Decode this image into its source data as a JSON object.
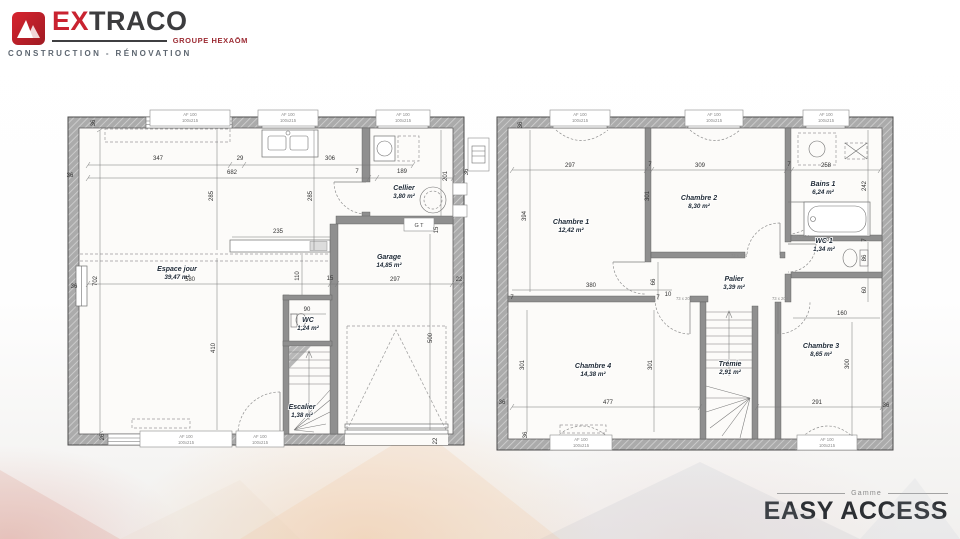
{
  "logo": {
    "brand_primary": "EX",
    "brand_secondary": "TRACO",
    "group_label": "GROUPE HEXAŌM",
    "tagline": "CONSTRUCTION - RÉNOVATION",
    "brand_red": "#c92330",
    "brand_dark": "#3c3c3e"
  },
  "footer": {
    "range_label": "Gamme",
    "range_name": "EASY ACCESS"
  },
  "plans": {
    "ground_floor": {
      "rooms": [
        {
          "name": "Espace jour",
          "area": "39,47 m²",
          "x": 177,
          "y": 271
        },
        {
          "name": "Cellier",
          "area": "3,80 m²",
          "x": 404,
          "y": 190
        },
        {
          "name": "Garage",
          "area": "14,85 m²",
          "x": 389,
          "y": 259
        },
        {
          "name": "WC",
          "area": "1,24 m²",
          "x": 308,
          "y": 322
        },
        {
          "name": "Escalier",
          "area": "1,38 m²",
          "x": 302,
          "y": 409
        }
      ],
      "dims": [
        {
          "t": "347",
          "x": 158,
          "y": 160
        },
        {
          "t": "29",
          "x": 240,
          "y": 160
        },
        {
          "t": "306",
          "x": 330,
          "y": 160
        },
        {
          "t": "682",
          "x": 232,
          "y": 174
        },
        {
          "t": "7",
          "x": 357,
          "y": 173
        },
        {
          "t": "189",
          "x": 402,
          "y": 173
        },
        {
          "t": "285",
          "x": 213,
          "y": 196,
          "r": -90
        },
        {
          "t": "285",
          "x": 312,
          "y": 196,
          "r": -90
        },
        {
          "t": "201",
          "x": 447,
          "y": 176,
          "r": -90
        },
        {
          "t": "36",
          "x": 70,
          "y": 177
        },
        {
          "t": "36",
          "x": 95,
          "y": 123,
          "r": -90
        },
        {
          "t": "36",
          "x": 468,
          "y": 172,
          "r": -90
        },
        {
          "t": "235",
          "x": 278,
          "y": 233
        },
        {
          "t": "110",
          "x": 299,
          "y": 276,
          "r": -90
        },
        {
          "t": "580",
          "x": 190,
          "y": 281
        },
        {
          "t": "15",
          "x": 330,
          "y": 280
        },
        {
          "t": "297",
          "x": 395,
          "y": 281
        },
        {
          "t": "22",
          "x": 459,
          "y": 281
        },
        {
          "t": "702",
          "x": 97,
          "y": 281,
          "r": -90
        },
        {
          "t": "410",
          "x": 215,
          "y": 348,
          "r": -90
        },
        {
          "t": "90",
          "x": 307,
          "y": 311
        },
        {
          "t": "15",
          "x": 438,
          "y": 230,
          "r": -90
        },
        {
          "t": "500",
          "x": 432,
          "y": 338,
          "r": -90
        },
        {
          "t": "36",
          "x": 74,
          "y": 288
        },
        {
          "t": "26",
          "x": 104,
          "y": 437,
          "r": -90
        },
        {
          "t": "22",
          "x": 437,
          "y": 441,
          "r": -90
        }
      ],
      "tiny": [
        {
          "t": "AF 100",
          "x": 190,
          "y": 116
        },
        {
          "t": "100x215",
          "x": 190,
          "y": 122
        },
        {
          "t": "AF 100",
          "x": 288,
          "y": 116
        },
        {
          "t": "100x215",
          "x": 288,
          "y": 122
        },
        {
          "t": "AF 100",
          "x": 403,
          "y": 116
        },
        {
          "t": "100x215",
          "x": 403,
          "y": 122
        },
        {
          "t": "AF 100",
          "x": 186,
          "y": 438
        },
        {
          "t": "100x215",
          "x": 186,
          "y": 444
        },
        {
          "t": "AF 100",
          "x": 260,
          "y": 438
        },
        {
          "t": "100x215",
          "x": 260,
          "y": 444
        },
        {
          "t": "G T",
          "x": 419,
          "y": 227,
          "c": "gt"
        }
      ]
    },
    "first_floor": {
      "rooms": [
        {
          "name": "Chambre 1",
          "area": "12,42 m²",
          "x": 571,
          "y": 224
        },
        {
          "name": "Chambre 2",
          "area": "8,30 m²",
          "x": 699,
          "y": 200
        },
        {
          "name": "Bains 1",
          "area": "6,24 m²",
          "x": 823,
          "y": 186
        },
        {
          "name": "WC 1",
          "area": "1,34 m²",
          "x": 824,
          "y": 243
        },
        {
          "name": "Palier",
          "area": "3,39 m²",
          "x": 734,
          "y": 281
        },
        {
          "name": "Chambre 4",
          "area": "14,38 m²",
          "x": 593,
          "y": 368
        },
        {
          "name": "Trémie",
          "area": "2,91 m²",
          "x": 730,
          "y": 366
        },
        {
          "name": "Chambre 3",
          "area": "8,65 m²",
          "x": 821,
          "y": 348
        }
      ],
      "dims": [
        {
          "t": "297",
          "x": 570,
          "y": 167
        },
        {
          "t": "7",
          "x": 650,
          "y": 166
        },
        {
          "t": "309",
          "x": 700,
          "y": 167
        },
        {
          "t": "7",
          "x": 789,
          "y": 166
        },
        {
          "t": "258",
          "x": 826,
          "y": 167
        },
        {
          "t": "394",
          "x": 526,
          "y": 216,
          "r": -90
        },
        {
          "t": "301",
          "x": 649,
          "y": 196,
          "r": -90
        },
        {
          "t": "242",
          "x": 866,
          "y": 186,
          "r": -90
        },
        {
          "t": "36",
          "x": 522,
          "y": 125,
          "r": -90
        },
        {
          "t": "66",
          "x": 655,
          "y": 282,
          "r": -90
        },
        {
          "t": "380",
          "x": 591,
          "y": 287
        },
        {
          "t": "10",
          "x": 668,
          "y": 296
        },
        {
          "t": "7",
          "x": 866,
          "y": 240,
          "r": -90
        },
        {
          "t": "86",
          "x": 866,
          "y": 258,
          "r": -90
        },
        {
          "t": "60",
          "x": 866,
          "y": 290,
          "r": -90
        },
        {
          "t": "160",
          "x": 842,
          "y": 315
        },
        {
          "t": "300",
          "x": 849,
          "y": 364,
          "r": -90
        },
        {
          "t": "301",
          "x": 524,
          "y": 365,
          "r": -90
        },
        {
          "t": "301",
          "x": 652,
          "y": 365,
          "r": -90
        },
        {
          "t": "477",
          "x": 608,
          "y": 404
        },
        {
          "t": "291",
          "x": 817,
          "y": 404
        },
        {
          "t": "36",
          "x": 502,
          "y": 404
        },
        {
          "t": "36",
          "x": 886,
          "y": 407
        },
        {
          "t": "36",
          "x": 527,
          "y": 435,
          "r": -90
        },
        {
          "t": "7",
          "x": 512,
          "y": 299
        },
        {
          "t": "7",
          "x": 658,
          "y": 299
        }
      ],
      "tiny": [
        {
          "t": "AF 100",
          "x": 580,
          "y": 116
        },
        {
          "t": "100x215",
          "x": 580,
          "y": 122
        },
        {
          "t": "AF 100",
          "x": 714,
          "y": 116
        },
        {
          "t": "100x215",
          "x": 714,
          "y": 122
        },
        {
          "t": "AF 100",
          "x": 826,
          "y": 116
        },
        {
          "t": "100x215",
          "x": 826,
          "y": 122
        },
        {
          "t": "AF 100",
          "x": 581,
          "y": 441
        },
        {
          "t": "100x215",
          "x": 581,
          "y": 447
        },
        {
          "t": "AF 100",
          "x": 827,
          "y": 441
        },
        {
          "t": "100x215",
          "x": 827,
          "y": 447
        },
        {
          "t": "73 x 204",
          "x": 739,
          "y": 257
        },
        {
          "t": "73 x 204",
          "x": 684,
          "y": 300
        },
        {
          "t": "73 x 204",
          "x": 780,
          "y": 300
        },
        {
          "t": "73 x 204",
          "x": 801,
          "y": 238
        }
      ]
    }
  }
}
